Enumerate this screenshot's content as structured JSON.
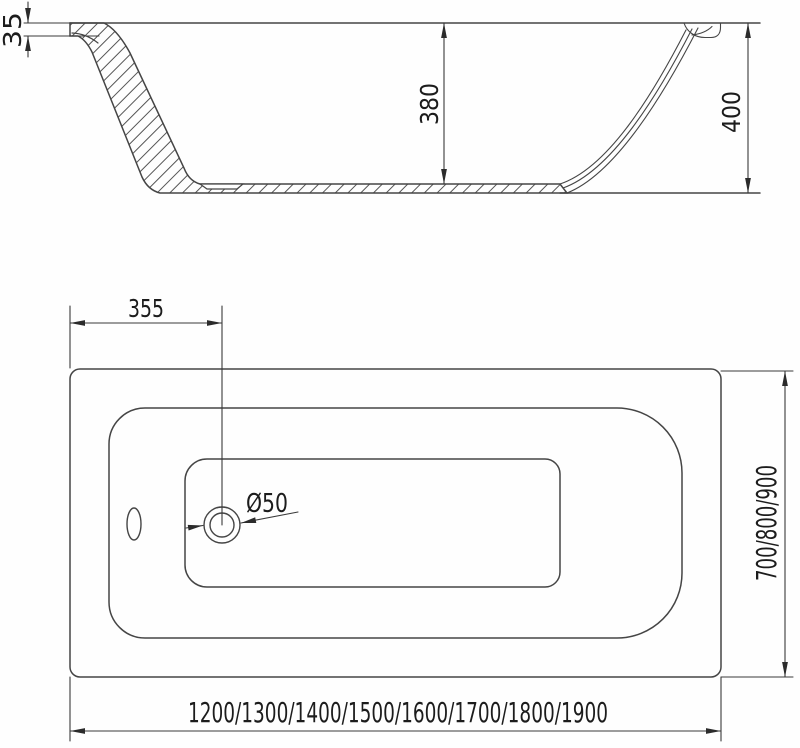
{
  "drawing": {
    "type_note": "bathtub technical drawing, two orthographic views",
    "colors": {
      "line": "#454545",
      "dimension_line": "#3a3a3a",
      "text": "#1c1c1c",
      "background": "#ffffff"
    },
    "side_view": {
      "rim_height": "35",
      "inner_depth": "380",
      "total_height": "400"
    },
    "plan_view": {
      "drain_offset": "355",
      "drain_diameter": "Ø50",
      "width_options": "700/800/900",
      "length_options": "1200/1300/1400/1500/1600/1700/1800/1900"
    }
  }
}
